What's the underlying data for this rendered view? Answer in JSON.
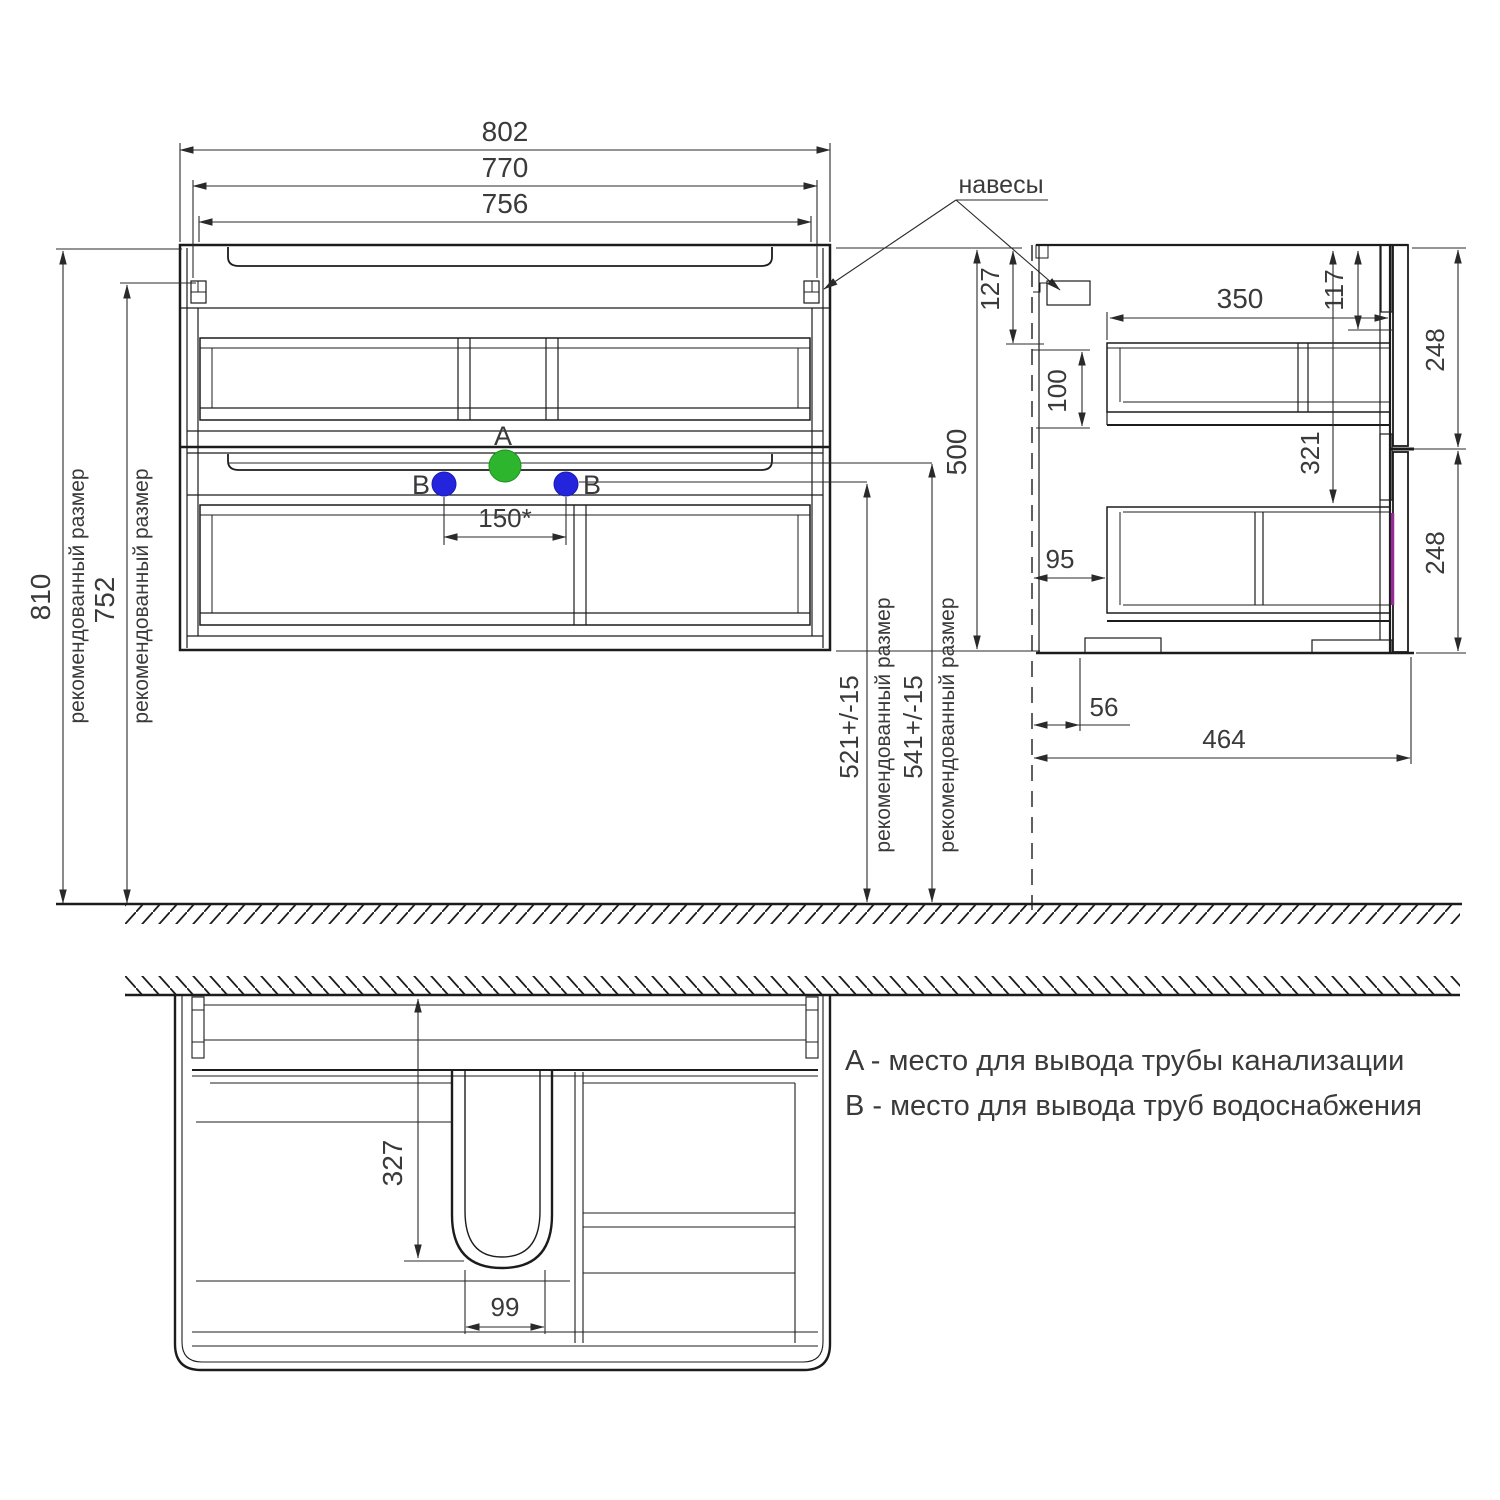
{
  "labels": {
    "hangers": "навесы",
    "recommended_note": "рекомендованный размер"
  },
  "front_view": {
    "dim_width_total": "802",
    "dim_width_hangers": "770",
    "dim_width_inner": "756",
    "dim_height_total": "810",
    "dim_height_hangers": "752",
    "dim_drain_spacing": "150*",
    "marker_a": "A",
    "marker_b": "B",
    "dim_b_height": "521+/-15",
    "dim_a_height": "541+/-15",
    "dim_cabinet_height": "500"
  },
  "side_view": {
    "dim_hanger_offset": "127",
    "dim_hanger_gap": "100",
    "dim_inner_depth": "350",
    "dim_front_top": "117",
    "dim_upper_front": "248",
    "dim_travel": "321",
    "dim_back_gap": "95",
    "dim_lower_front": "248",
    "dim_foot_offset": "56",
    "dim_total_depth": "464"
  },
  "bottom_view": {
    "dim_drain_depth": "327",
    "dim_drain_width": "99"
  },
  "legend": {
    "item_a": "A - место для вывода трубы канализации",
    "item_b": "B - место для вывода труб водоснабжения"
  },
  "colors": {
    "line": "#1c1c1c",
    "marker_a_fill": "#2db52d",
    "marker_b_fill": "#2424dc",
    "accent_magenta": "#952c95"
  }
}
